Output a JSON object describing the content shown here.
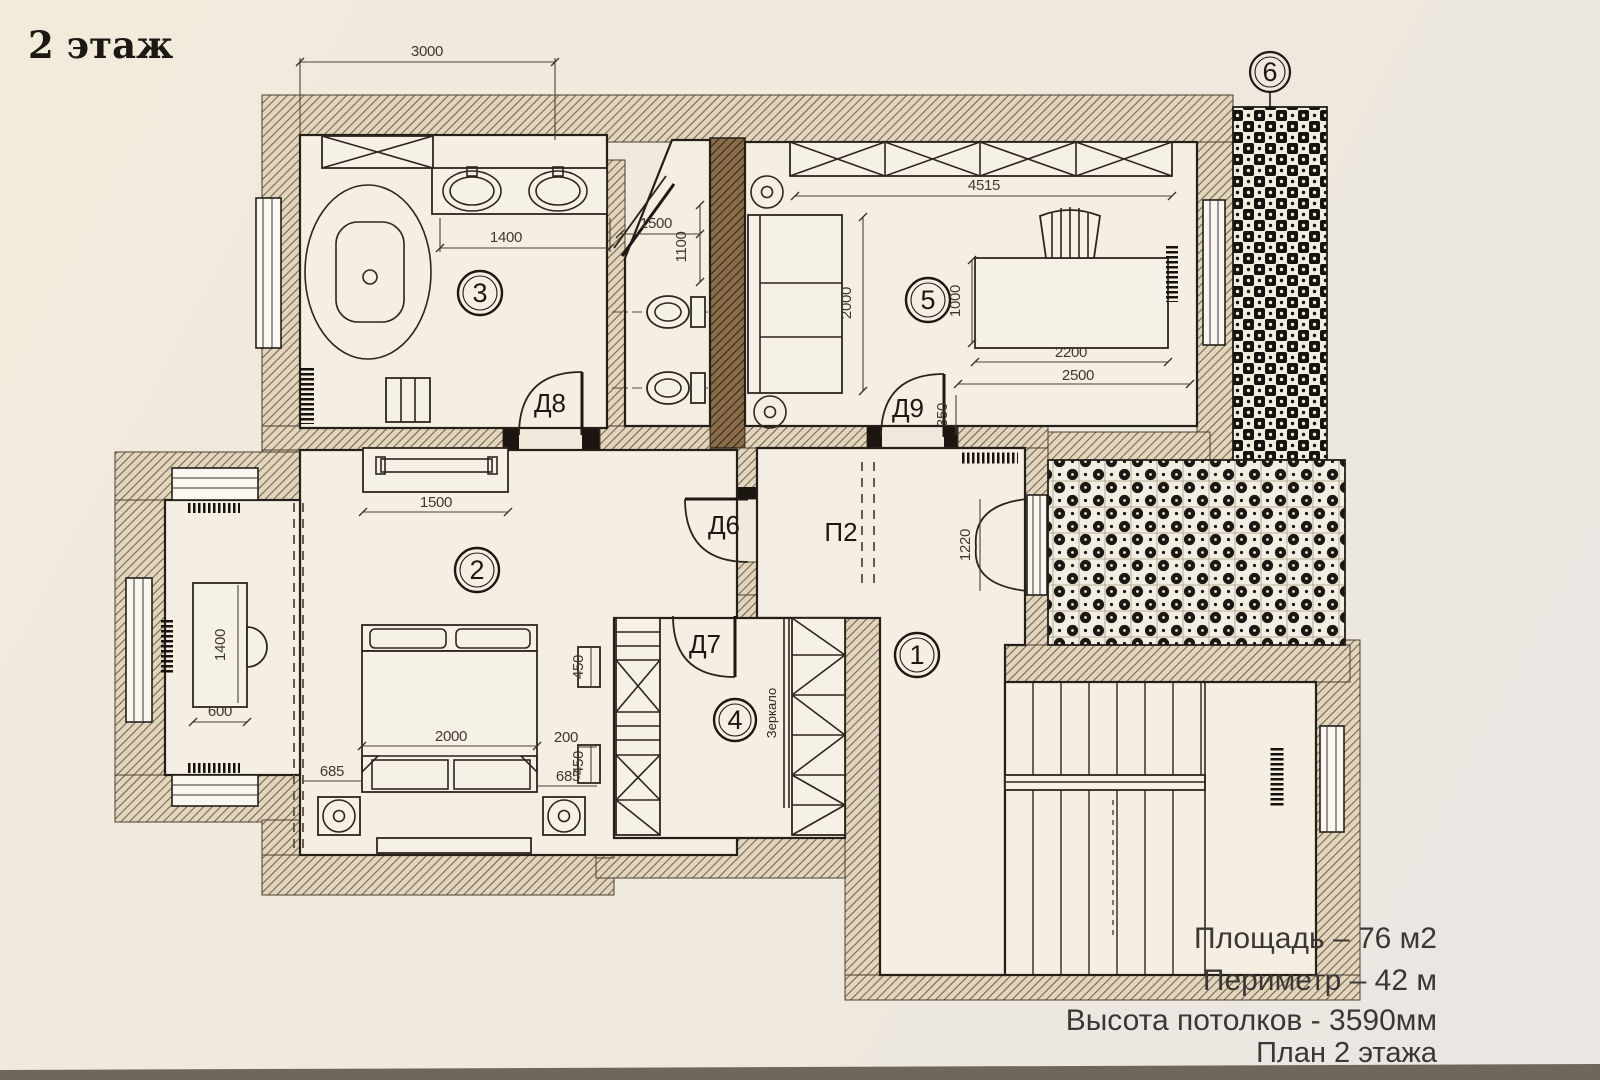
{
  "title": "2 этаж",
  "plan": {
    "rooms": [
      {
        "id": "1",
        "label": "1"
      },
      {
        "id": "2",
        "label": "2"
      },
      {
        "id": "3",
        "label": "3"
      },
      {
        "id": "4",
        "label": "4"
      },
      {
        "id": "5",
        "label": "5"
      },
      {
        "id": "6",
        "label": "6"
      }
    ],
    "doors": {
      "d6": "Д6",
      "d7": "Д7",
      "d8": "Д8",
      "d9": "Д9",
      "p2": "П2"
    },
    "annotations": {
      "mirror": "Зеркало"
    },
    "dimensions_mm": {
      "top_wall": "3000",
      "r5_wardrobe": "4515",
      "bath_vanity": "1400",
      "wc_width": "1500",
      "wc_depth": "1100",
      "r5_sofa": "2000",
      "r5_desk_depth": "1000",
      "r5_desk_width": "2200",
      "r5_desk_total": "2500",
      "d9_offset": "350",
      "r1_window": "1220",
      "r2_tv": "1500",
      "alcove_desk_length": "1400",
      "alcove_desk_width": "600",
      "bed_width": "2000",
      "bed_left": "685",
      "closet_gap": "200",
      "closet_top": "450",
      "closet_bottom": "450",
      "bed_right": "685"
    }
  },
  "caption": {
    "area": "Площадь – 76 м2",
    "perimeter": "Периметр – 42 м",
    "ceiling_height": "Высота потолков - 3590мм",
    "plan_name": "План 2 этажа"
  },
  "colors": {
    "paper": "#f0e9da",
    "wall_hatch": "#75624a",
    "ink": "#241f19",
    "table_edge": "#6f675c"
  }
}
